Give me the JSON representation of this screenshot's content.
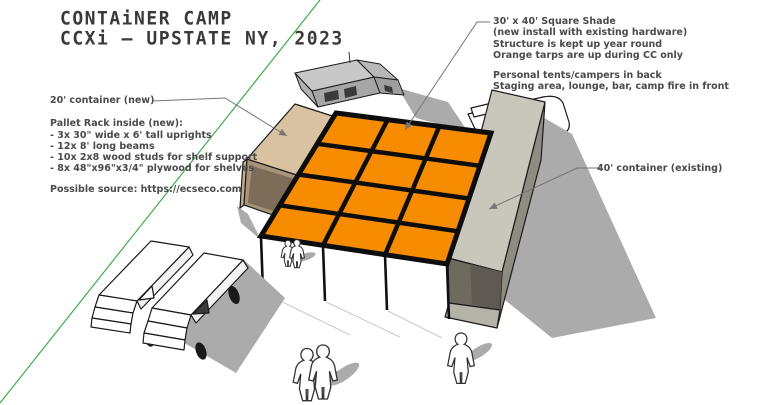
{
  "title": {
    "line1": "CONTAiNER CAMP",
    "line2": "CCXi — UPSTATE NY, 2023"
  },
  "annotations": {
    "container20_label": "20' container (new)",
    "pallet_rack": {
      "heading": "Pallet Rack inside (new):",
      "items": [
        "- 3x 30\" wide x 6' tall uprights",
        "- 12x 8' long beams",
        "- 10x 2x8 wood studs for shelf support",
        "- 8x 48\"x96\"x3/4\" plywood for shelves"
      ]
    },
    "source_note": "Possible source: https://ecseco.com",
    "shade_note": {
      "lines": [
        "30' x 40' Square Shade",
        "(new install with existing hardware)",
        "Structure is kept up year round",
        "Orange tarps are up during CC only"
      ]
    },
    "usage_note": {
      "lines": [
        "Personal tents/campers in back",
        "Staging area, lounge, bar, camp fire in front"
      ]
    },
    "container40_label": "40' container (existing)"
  },
  "scene": {
    "shade_canopy": {
      "grid_columns": 3,
      "grid_rows": 4,
      "tarp_color": "#F78C00",
      "frame_color": "#0d0d0d"
    },
    "axis_line_color": "#3FAE49",
    "shadow_color": "#ABABAB",
    "container20_color": "#D8C2A2",
    "container40_color": "#C9C6BC",
    "vehicle_color": "#FFFFFF"
  }
}
